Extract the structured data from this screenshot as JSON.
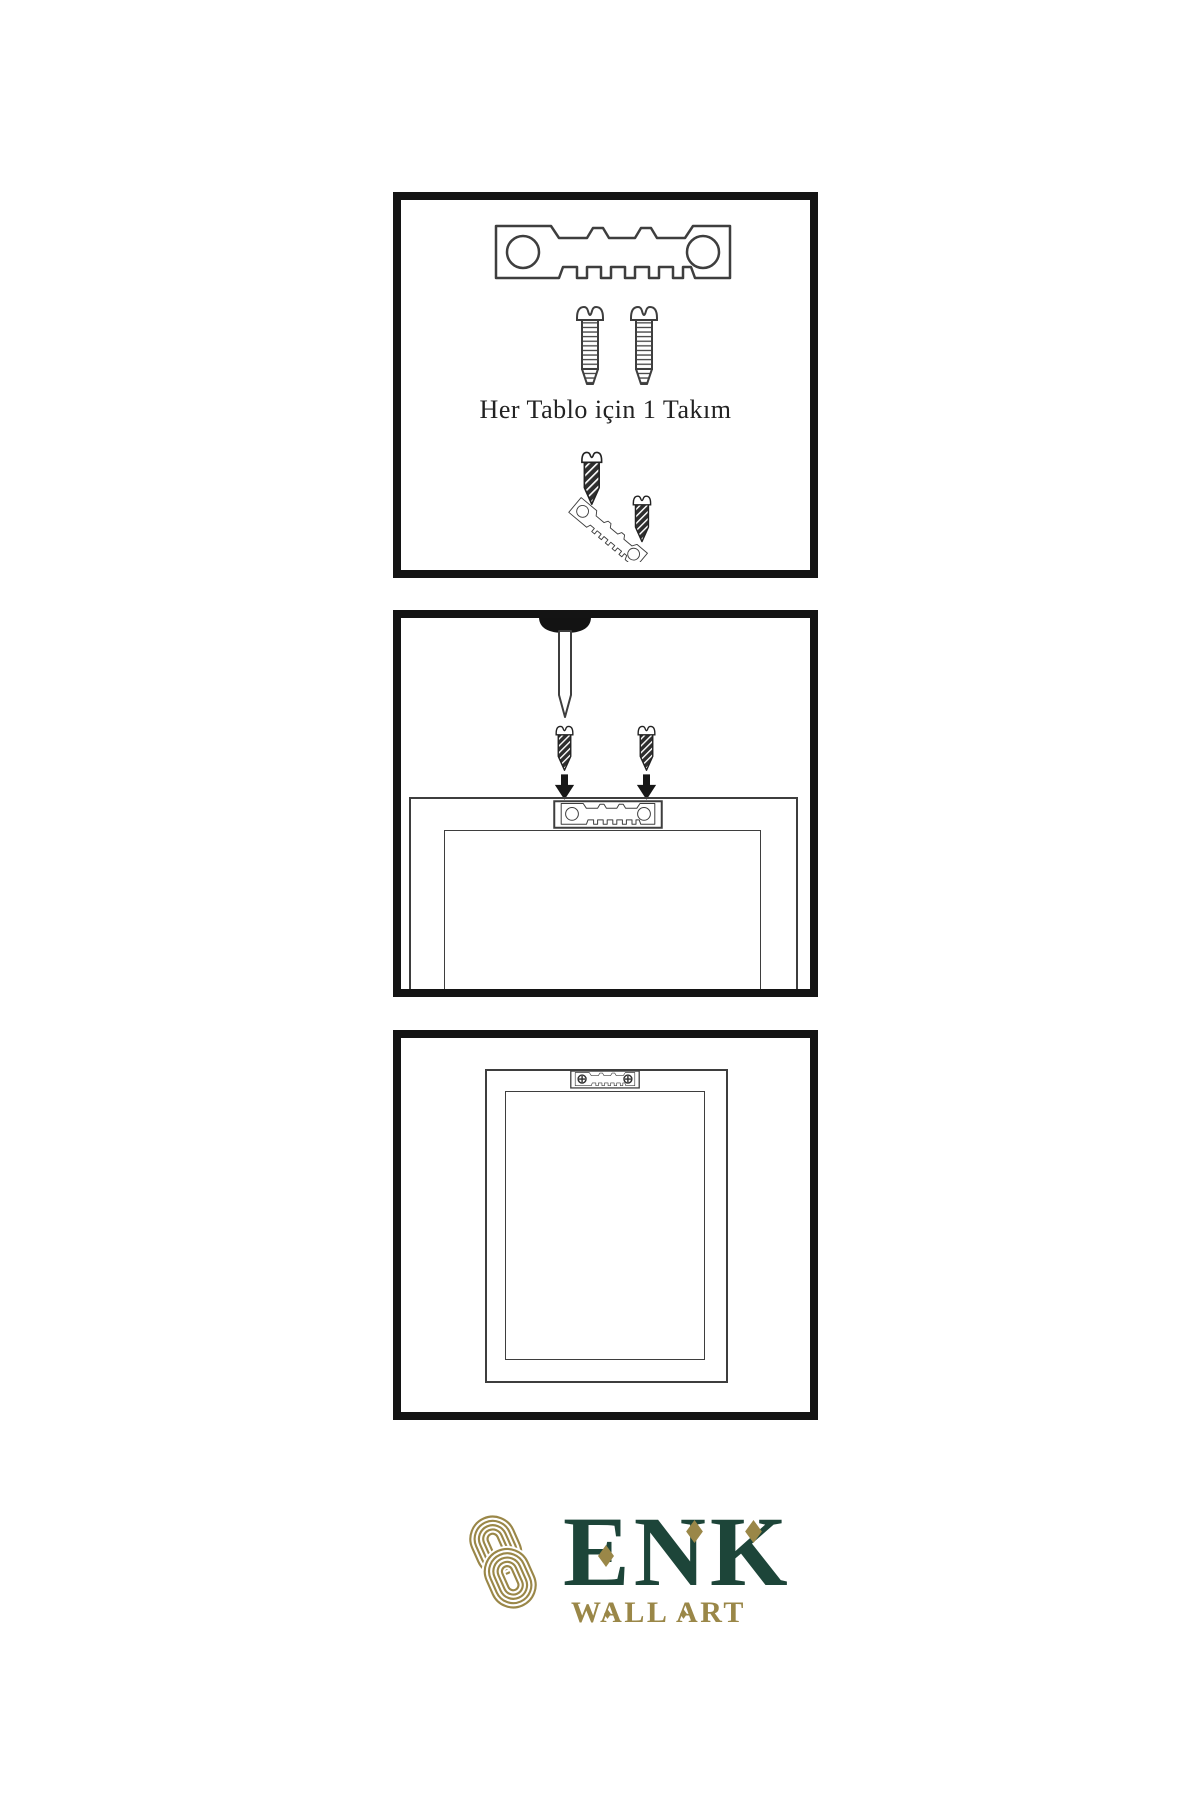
{
  "document": {
    "type": "wall-art-hanging-instructions",
    "background": "#ffffff"
  },
  "colors": {
    "panel_border": "#141414",
    "drawing_line": "#3e3e3e",
    "screw_dark_fill": "#2e2e2e",
    "brand_green": "#1d4539",
    "brand_gold": "#9a8748",
    "caption_text": "#222222"
  },
  "steps": [
    {
      "name": "hardware-kit",
      "caption": "Her Tablo için 1 Takım",
      "icons": [
        "sawtooth-hanger-icon",
        "screw-icon",
        "screw-icon",
        "screw-into-hanger-icon"
      ]
    },
    {
      "name": "attach-hanger-to-frame",
      "icons": [
        "wall-nail-icon",
        "screw-icon",
        "screw-icon",
        "arrow-down-icon",
        "arrow-down-icon",
        "frame-back-top-icon",
        "sawtooth-hanger-icon"
      ]
    },
    {
      "name": "frame-back-finished",
      "icons": [
        "frame-back-icon",
        "mounted-sawtooth-hanger-icon"
      ]
    }
  ],
  "brand": {
    "wordmark": "ENK",
    "subtitle": "WALL ART",
    "emblem": "interlaced-knot-icon"
  }
}
